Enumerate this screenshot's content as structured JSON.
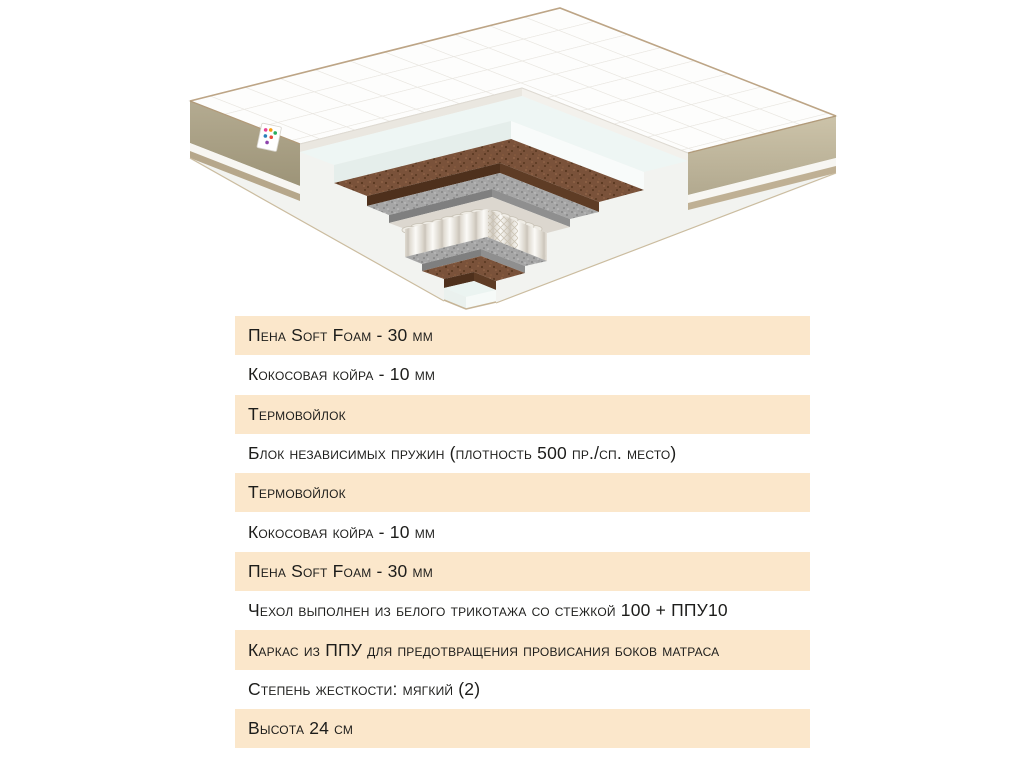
{
  "illustration": {
    "description": "mattress-cutaway-3d",
    "colors": {
      "quilt": "#fdfdfc",
      "quilt_lines": "#e7e4de",
      "piping": "#bda586",
      "side_left": "#aca189",
      "side_right": "#c6bda3",
      "rail": "#bfb094",
      "foam": "#eef6f4",
      "coir": "#7a523a",
      "coir_face": "#5e3c25",
      "felt": "#a6a6a6",
      "felt_face": "#8f8f8f",
      "springs": "#f6f4ef",
      "springs_gap": "#cfc9bf",
      "base": "#ebf4f1"
    }
  },
  "table": {
    "highlight_color": "#fbe7cb",
    "text_color": "#1d1d1b",
    "rows": [
      {
        "text": "Пена Soft Foam - 30 мм",
        "shaded": true
      },
      {
        "text": "Кокосовая койра - 10 мм",
        "shaded": false
      },
      {
        "text": "Термовойлок",
        "shaded": true
      },
      {
        "text": "Блок независимых пружин (плотность 500 пр./сп. место)",
        "shaded": false
      },
      {
        "text": "Термовойлок",
        "shaded": true
      },
      {
        "text": "Кокосовая койра - 10 мм",
        "shaded": false
      },
      {
        "text": "Пена Soft Foam - 30 мм",
        "shaded": true
      },
      {
        "text": "Чехол выполнен из белого трикотажа со стежкой 100 + ППУ10",
        "shaded": false
      },
      {
        "text": "Каркас из ППУ для предотвращения провисания боков матраса",
        "shaded": true
      },
      {
        "text": "Степень жесткости: мягкий (2)",
        "shaded": false
      },
      {
        "text": "Высота 24 см",
        "shaded": true
      }
    ]
  }
}
